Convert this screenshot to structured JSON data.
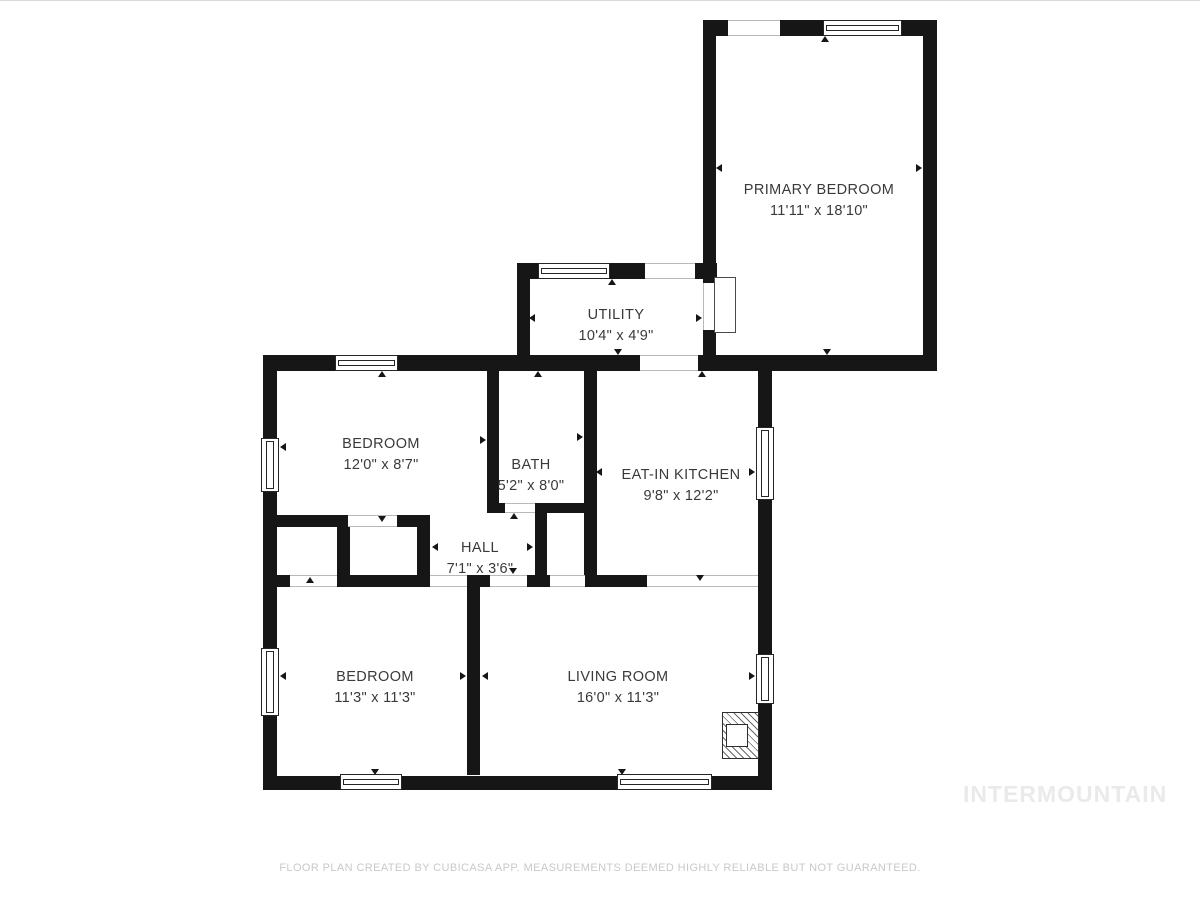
{
  "page": {
    "background": "#ffffff"
  },
  "watermark": {
    "text": "INTERMOUNTAIN",
    "color": "#eaeaea"
  },
  "footer": {
    "text": "FLOOR PLAN CREATED BY CUBICASA APP. MEASUREMENTS DEEMED HIGHLY RELIABLE BUT NOT GUARANTEED."
  },
  "plan": {
    "wall_color": "#161616",
    "rooms": [
      {
        "name": "PRIMARY BEDROOM",
        "dims": "11'11\" x 18'10\"",
        "cx": 819,
        "cy": 201
      },
      {
        "name": "UTILITY",
        "dims": "10'4\" x 4'9\"",
        "cx": 616,
        "cy": 326
      },
      {
        "name": "BEDROOM",
        "dims": "12'0\" x 8'7\"",
        "cx": 381,
        "cy": 455
      },
      {
        "name": "BATH",
        "dims": "5'2\" x 8'0\"",
        "cx": 531,
        "cy": 476
      },
      {
        "name": "EAT-IN KITCHEN",
        "dims": "9'8\" x 12'2\"",
        "cx": 681,
        "cy": 486
      },
      {
        "name": "HALL",
        "dims": "7'1\" x 3'6\"",
        "cx": 480,
        "cy": 559
      },
      {
        "name": "BEDROOM",
        "dims": "11'3\" x 11'3\"",
        "cx": 375,
        "cy": 688
      },
      {
        "name": "LIVING ROOM",
        "dims": "16'0\" x 11'3\"",
        "cx": 618,
        "cy": 688
      }
    ],
    "walls": [
      [
        703,
        20,
        25,
        16
      ],
      [
        780,
        20,
        43,
        16
      ],
      [
        902,
        20,
        35,
        16
      ],
      [
        923,
        20,
        14,
        351
      ],
      [
        703,
        20,
        13,
        263
      ],
      [
        703,
        330,
        13,
        41
      ],
      [
        517,
        263,
        21,
        16
      ],
      [
        610,
        263,
        35,
        16
      ],
      [
        695,
        263,
        22,
        16
      ],
      [
        517,
        263,
        13,
        108
      ],
      [
        263,
        355,
        72,
        16
      ],
      [
        398,
        355,
        242,
        16
      ],
      [
        698,
        355,
        239,
        16
      ],
      [
        263,
        355,
        14,
        435
      ],
      [
        487,
        371,
        12,
        142
      ],
      [
        487,
        503,
        18,
        10
      ],
      [
        535,
        503,
        50,
        10
      ],
      [
        584,
        371,
        13,
        204
      ],
      [
        535,
        503,
        12,
        84
      ],
      [
        263,
        515,
        85,
        12
      ],
      [
        397,
        515,
        33,
        12
      ],
      [
        337,
        515,
        13,
        72
      ],
      [
        417,
        515,
        13,
        72
      ],
      [
        263,
        575,
        27,
        12
      ],
      [
        337,
        575,
        93,
        12
      ],
      [
        467,
        575,
        23,
        12
      ],
      [
        527,
        575,
        23,
        12
      ],
      [
        585,
        575,
        62,
        12
      ],
      [
        467,
        587,
        13,
        188
      ],
      [
        263,
        776,
        77,
        14
      ],
      [
        402,
        776,
        215,
        14
      ],
      [
        712,
        776,
        60,
        14
      ],
      [
        758,
        371,
        14,
        56
      ],
      [
        758,
        500,
        14,
        154
      ],
      [
        758,
        704,
        14,
        86
      ]
    ],
    "windows": [
      [
        823,
        20,
        79,
        16,
        "h"
      ],
      [
        538,
        263,
        72,
        16,
        "h"
      ],
      [
        335,
        355,
        63,
        16,
        "h"
      ],
      [
        340,
        774,
        62,
        16,
        "h"
      ],
      [
        617,
        774,
        95,
        16,
        "h"
      ],
      [
        261,
        438,
        18,
        54,
        "v"
      ],
      [
        261,
        648,
        18,
        68,
        "v"
      ],
      [
        756,
        427,
        18,
        73,
        "v"
      ],
      [
        756,
        654,
        18,
        50,
        "v"
      ]
    ],
    "openings": [
      [
        728,
        20,
        52,
        16,
        "h"
      ],
      [
        645,
        263,
        50,
        16,
        "h"
      ],
      [
        640,
        355,
        58,
        16,
        "h"
      ],
      [
        348,
        515,
        49,
        12,
        "h"
      ],
      [
        290,
        575,
        47,
        12,
        "h"
      ],
      [
        430,
        575,
        37,
        12,
        "h"
      ],
      [
        490,
        575,
        37,
        12,
        "h"
      ],
      [
        550,
        575,
        35,
        12,
        "h"
      ],
      [
        647,
        575,
        111,
        12,
        "h"
      ],
      [
        505,
        503,
        30,
        10,
        "h"
      ],
      [
        703,
        283,
        13,
        47,
        "v"
      ]
    ],
    "door_leaves": [
      [
        714,
        277,
        22,
        56
      ]
    ],
    "fireplace": {
      "box": [
        722,
        712,
        37,
        47
      ],
      "notch": [
        726,
        724,
        22,
        23
      ]
    },
    "markers": [
      [
        382,
        371,
        "up"
      ],
      [
        825,
        36,
        "up"
      ],
      [
        612,
        279,
        "up"
      ],
      [
        538,
        371,
        "up"
      ],
      [
        702,
        371,
        "up"
      ],
      [
        514,
        513,
        "up"
      ],
      [
        310,
        577,
        "up"
      ],
      [
        827,
        355,
        "down"
      ],
      [
        618,
        355,
        "down"
      ],
      [
        382,
        522,
        "down"
      ],
      [
        513,
        574,
        "down"
      ],
      [
        700,
        581,
        "down"
      ],
      [
        375,
        775,
        "down"
      ],
      [
        622,
        775,
        "down"
      ],
      [
        716,
        168,
        "left"
      ],
      [
        529,
        318,
        "left"
      ],
      [
        280,
        447,
        "left"
      ],
      [
        596,
        472,
        "left"
      ],
      [
        432,
        547,
        "left"
      ],
      [
        280,
        676,
        "left"
      ],
      [
        482,
        676,
        "left"
      ],
      [
        922,
        168,
        "right"
      ],
      [
        702,
        318,
        "right"
      ],
      [
        486,
        440,
        "right"
      ],
      [
        583,
        437,
        "right"
      ],
      [
        755,
        472,
        "right"
      ],
      [
        533,
        547,
        "right"
      ],
      [
        466,
        676,
        "right"
      ],
      [
        755,
        676,
        "right"
      ]
    ]
  }
}
